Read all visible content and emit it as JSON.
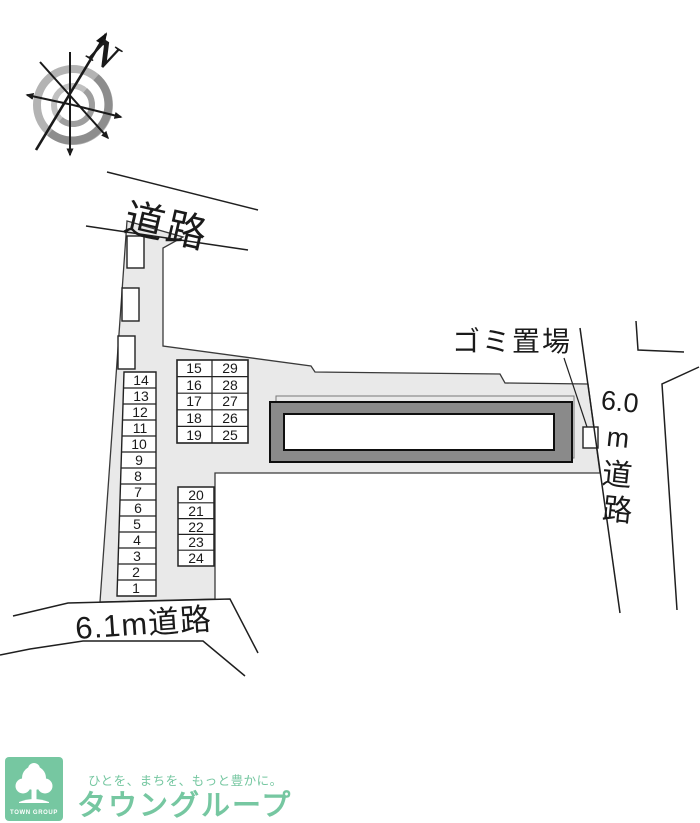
{
  "plan": {
    "compass": {
      "north_label": "N"
    },
    "roads": {
      "top_label": "道路",
      "bottom_label": "6.1m道路",
      "right_chars": [
        "6.0",
        "m",
        "道",
        "路"
      ]
    },
    "labels": {
      "garbage_area": "ゴミ置場"
    },
    "parking": {
      "left_column": [
        "14",
        "13",
        "12",
        "11",
        "10",
        "9",
        "8",
        "7",
        "6",
        "5",
        "4",
        "3",
        "2",
        "1"
      ],
      "center_grid_left": [
        "15",
        "16",
        "17",
        "18",
        "19"
      ],
      "center_grid_right": [
        "29",
        "28",
        "27",
        "26",
        "25"
      ],
      "lower_column": [
        "20",
        "21",
        "22",
        "23",
        "24"
      ]
    },
    "colors": {
      "site_fill": "#e9e9e9",
      "building_band": "#8a8a8a",
      "line": "#1a1a1a"
    }
  },
  "footer": {
    "logo_caption": "TOWN GROUP",
    "tagline": "ひとを、まちを、もっと豊かに。",
    "brand": "タウングループ",
    "brand_color": "#76c7a1"
  }
}
